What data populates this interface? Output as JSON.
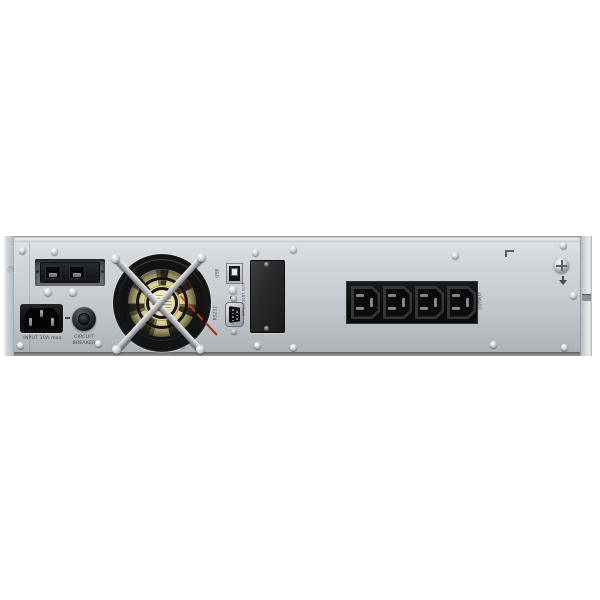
{
  "scene": {
    "type": "product-photo",
    "subject": "rack-mount UPS rear panel",
    "background_color": "#ffffff"
  },
  "panel": {
    "labels": {
      "input": "INPUT 10A max.",
      "circuit_breaker_line1": "CIRCUIT",
      "circuit_breaker_line2": "BREAKER",
      "usb": "USB",
      "serial": "RS232",
      "intelligent_slot": "INTELLIGENT SLOT",
      "output": "OUTPUT"
    },
    "outlets": {
      "count": 4
    },
    "colors": {
      "chassis_light": "#d8dcdf",
      "chassis_dark": "#adb2b6",
      "connector_black": "#141517",
      "fan_blade_yellow": "#e0d48e",
      "fan_sticker_cream": "#ece4b4",
      "wire_red": "#c43a2e",
      "label_text": "#3f4347"
    }
  }
}
